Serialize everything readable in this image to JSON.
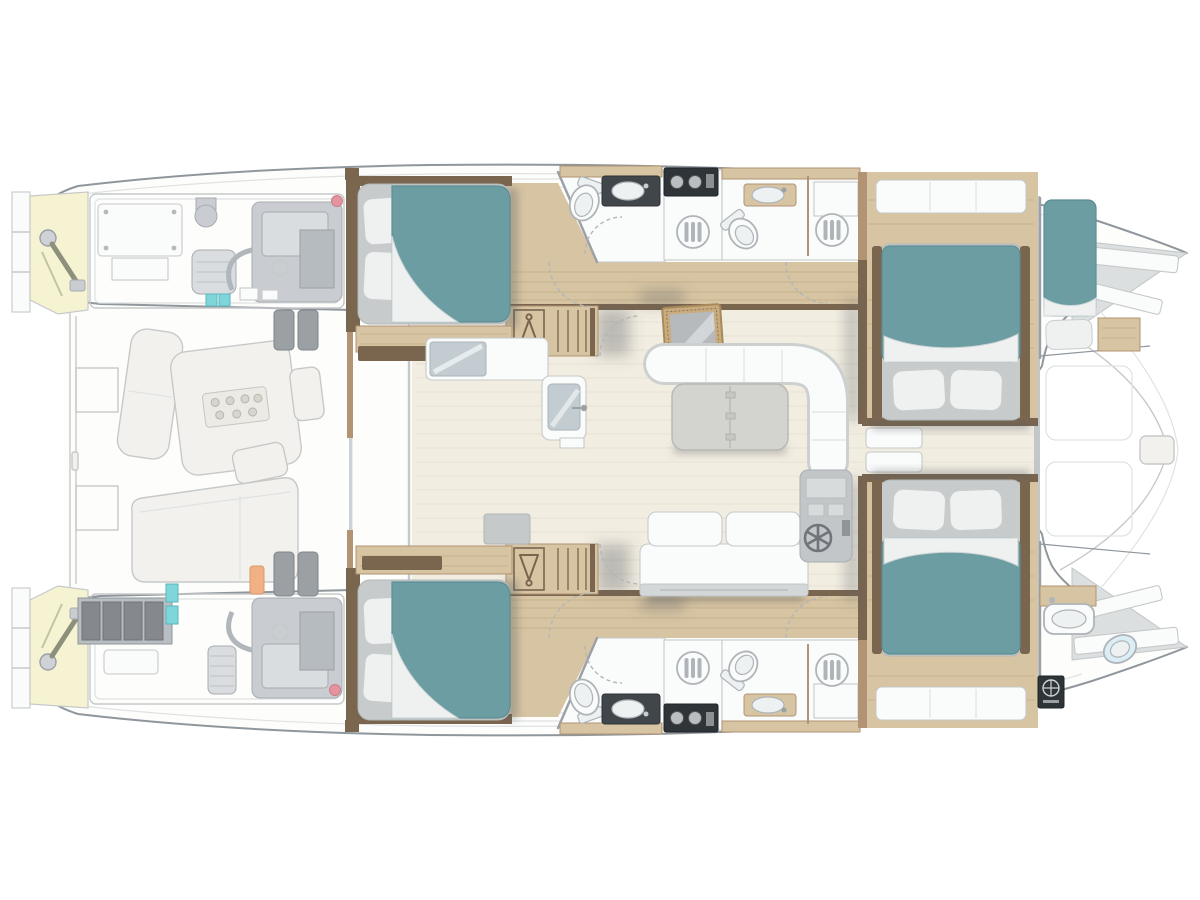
{
  "meta": {
    "title": "Catamaran motor yacht deck plan: four guest cabins with teal berths, four heads with showers, central salon with galley, folding table, C-sofa and helm station, ghosted aft cockpit, twin engine rooms, bow crew berth and crew head"
  },
  "palette": {
    "pageBg": "#ffffff",
    "hullLine": "#8f969c",
    "ghostLine": "#c7c9c9",
    "ghostLine2": "#dfe2e3",
    "ghostFill": "#f2f1ed",
    "deckWhite": "#fdfdfc",
    "bathWhite": "#fafbfb",
    "salonFloor": "#f2ede1",
    "floorGrain": "#e7e1d2",
    "wood": "#d7c4a2",
    "woodGrain": "#c8b28c",
    "woodDark": "#7a654e",
    "woodTrim": "#b29474",
    "teal": "#6c9da3",
    "tealEdge": "#5d8d93",
    "mattress": "#c7cbcc",
    "pillow": "#eff1f1",
    "fixture": "#aeb4b8",
    "glassGray": "#c3cdd1",
    "dark": "#2e3437",
    "counterDark": "#41464a",
    "paleYellow": "#f6f3d3",
    "cyan": "#7ed6da",
    "orange": "#f2b184",
    "pink": "#e5939e",
    "battery": "#85898d",
    "machine": "#c9cdd1",
    "tableGray": "#d3d3d0",
    "panelGray": "#c3c6c8",
    "shadow": "rgba(90,95,100,0.35)"
  },
  "areas": [
    "aft-swim-platforms",
    "port-steering-compartment",
    "starboard-steering-compartment",
    "port-engine-room",
    "starboard-engine-room",
    "aft-cockpit-with-dining-table",
    "port-aft-guest-cabin",
    "starboard-aft-guest-cabin",
    "port-forward-guest-cabin",
    "starboard-forward-guest-cabin",
    "four-heads-with-showers-and-toilets",
    "salon-with-galley-and-folding-table",
    "helm-station-with-wheel",
    "bow-crew-berth",
    "bow-crew-head",
    "foredeck-seats-between-bows"
  ],
  "counts": {
    "guest_cabins": 4,
    "heads": 4,
    "crew_berths": 1,
    "engine_rooms": 2
  }
}
